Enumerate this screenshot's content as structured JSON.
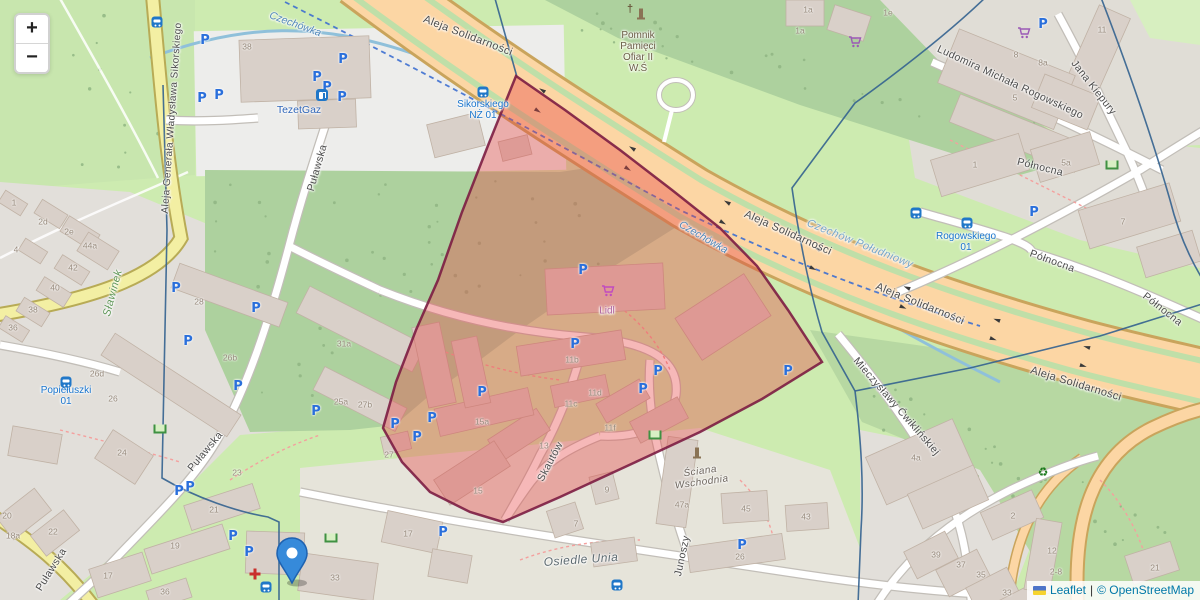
{
  "controls": {
    "zoom_in_label": "+",
    "zoom_out_label": "−"
  },
  "attribution": {
    "leaflet_link": "Leaflet",
    "separator": "|",
    "osm_text": "© OpenStreetMap"
  },
  "colors": {
    "overlay_fill": "#e84545",
    "overlay_stroke": "#7c1d42",
    "boundary": "#33628f",
    "marker_fill": "#368ada",
    "marker_stroke": "#1e62b0",
    "link": "#0078a8"
  },
  "overlay_polygon": {
    "points": "516,76 565,110 620,150 672,190 720,228 757,266 788,310 822,362 762,399 700,432 640,460 560,497 503,522 470,512 430,492 402,462 383,428 396,382 416,330 438,280 462,212 489,143",
    "fill_opacity": 0.38
  },
  "boundaries": [
    "M494,-5 L517,77",
    "M988,-5 C950,32 898,72 855,103 L792,188 C801,252 813,302 822,332 L855,391",
    "M855,391 L970,368 L1100,336 L1215,300",
    "M855,391 C861,440 864,485 861,530 L858,605",
    "M163,85 L167,230 L162,478 C196,498 238,512 268,517 L279,522 L279,605",
    "M1100,-5 C1125,60 1150,130 1170,200 C1180,240 1196,272 1215,298"
  ],
  "marker": {
    "x": 292,
    "y": 583
  },
  "map": {
    "street_labels": [
      {
        "text": "Aleja Solidarności",
        "x": 468,
        "y": 36,
        "rot": 21,
        "size": 11
      },
      {
        "text": "Aleja Solidarności",
        "x": 788,
        "y": 233,
        "rot": 24,
        "size": 11
      },
      {
        "text": "Aleja Solidarności",
        "x": 920,
        "y": 304,
        "rot": 22,
        "size": 11
      },
      {
        "text": "Aleja Solidarności",
        "x": 1076,
        "y": 384,
        "rot": 17,
        "size": 11
      },
      {
        "text": "Aleja Generała Władysława Sikorskiego",
        "x": 172,
        "y": 118,
        "rot": -86,
        "size": 10
      },
      {
        "text": "Puławska",
        "x": 318,
        "y": 168,
        "rot": -74
      },
      {
        "text": "Puławska",
        "x": 206,
        "y": 452,
        "rot": -50
      },
      {
        "text": "Puławska",
        "x": 52,
        "y": 570,
        "rot": -58
      },
      {
        "text": "Północna",
        "x": 1040,
        "y": 168,
        "rot": 14
      },
      {
        "text": "Północna",
        "x": 1052,
        "y": 262,
        "rot": 20
      },
      {
        "text": "Północna",
        "x": 1162,
        "y": 310,
        "rot": 38
      },
      {
        "text": "Ludomira Michała Rogowskiego",
        "x": 1010,
        "y": 83,
        "rot": 25
      },
      {
        "text": "Jana Kiepury",
        "x": 1093,
        "y": 88,
        "rot": 52
      },
      {
        "text": "Mieczysławy Ćwiklińskiej",
        "x": 896,
        "y": 407,
        "rot": 49
      },
      {
        "text": "Skautów",
        "x": 551,
        "y": 462,
        "rot": -62
      },
      {
        "text": "Junoszy",
        "x": 683,
        "y": 556,
        "rot": -78
      }
    ],
    "place_labels": [
      {
        "text": "Czechów Południowy",
        "x": 860,
        "y": 244,
        "rot": 22,
        "size": 11,
        "color": "#76a5c9"
      },
      {
        "text": "Sławinek",
        "x": 113,
        "y": 293,
        "rot": -75,
        "size": 11,
        "color": "#5f9657"
      },
      {
        "text": "Osiedle Unia",
        "x": 581,
        "y": 560,
        "rot": -4,
        "size": 12,
        "color": "#5d6a70"
      },
      {
        "lines": [
          "Ściana",
          "Wschodnia"
        ],
        "x": 701,
        "y": 477,
        "rot": -8,
        "size": 10,
        "color": "#6a625a"
      }
    ],
    "water_labels": [
      {
        "text": "Czechówka",
        "x": 295,
        "y": 25,
        "rot": 20
      },
      {
        "text": "Czechówka",
        "x": 703,
        "y": 238,
        "rot": 30
      }
    ],
    "bus_stop_labels": [
      {
        "lines": [
          "Sikorskiego",
          "NŻ 01"
        ],
        "x": 483,
        "y": 110
      },
      {
        "lines": [
          "Rogowskiego",
          "01"
        ],
        "x": 966,
        "y": 242
      },
      {
        "lines": [
          "Popiełuszki",
          "01"
        ],
        "x": 66,
        "y": 396
      }
    ],
    "poi_labels": [
      {
        "text": "TezetGaz",
        "x": 299,
        "y": 111,
        "color": "#3066b8",
        "size": 10.5
      },
      {
        "text": "Lidl",
        "x": 607,
        "y": 311,
        "color": "#b0639f"
      },
      {
        "lines": [
          "Pomnik",
          "Pamięci",
          "Ofiar II",
          "W.Ś"
        ],
        "x": 638,
        "y": 52,
        "color": "#6a5d45"
      }
    ],
    "house_numbers": [
      [
        247,
        47,
        "38"
      ],
      [
        43,
        222,
        "2d"
      ],
      [
        69,
        232,
        "2e"
      ],
      [
        90,
        246,
        "44a"
      ],
      [
        16,
        250,
        "4"
      ],
      [
        73,
        268,
        "42"
      ],
      [
        55,
        288,
        "40"
      ],
      [
        33,
        310,
        "38"
      ],
      [
        13,
        328,
        "36"
      ],
      [
        14,
        203,
        "1"
      ],
      [
        199,
        302,
        "28"
      ],
      [
        230,
        358,
        "26b"
      ],
      [
        344,
        344,
        "31a"
      ],
      [
        341,
        402,
        "25a"
      ],
      [
        365,
        405,
        "27b"
      ],
      [
        97,
        374,
        "26d"
      ],
      [
        113,
        399,
        "26"
      ],
      [
        122,
        453,
        "24"
      ],
      [
        237,
        473,
        "23"
      ],
      [
        7,
        516,
        "20"
      ],
      [
        13,
        536,
        "18a"
      ],
      [
        53,
        532,
        "22"
      ],
      [
        214,
        510,
        "21"
      ],
      [
        175,
        546,
        "19"
      ],
      [
        108,
        576,
        "17"
      ],
      [
        165,
        592,
        "36"
      ],
      [
        335,
        578,
        "33"
      ],
      [
        408,
        534,
        "17"
      ],
      [
        572,
        360,
        "11b"
      ],
      [
        482,
        422,
        "15a"
      ],
      [
        595,
        393,
        "11d"
      ],
      [
        571,
        404,
        "11c"
      ],
      [
        610,
        428,
        "11f"
      ],
      [
        544,
        446,
        "13"
      ],
      [
        389,
        455,
        "27"
      ],
      [
        478,
        491,
        "15"
      ],
      [
        607,
        490,
        "9"
      ],
      [
        576,
        524,
        "7"
      ],
      [
        682,
        505,
        "47a"
      ],
      [
        746,
        509,
        "45"
      ],
      [
        806,
        517,
        "43"
      ],
      [
        740,
        557,
        "26"
      ],
      [
        916,
        458,
        "4a"
      ],
      [
        936,
        555,
        "39"
      ],
      [
        961,
        565,
        "37"
      ],
      [
        981,
        575,
        "35"
      ],
      [
        1007,
        593,
        "33"
      ],
      [
        1013,
        516,
        "2"
      ],
      [
        1052,
        551,
        "12"
      ],
      [
        1056,
        572,
        "2-8"
      ],
      [
        1155,
        568,
        "21"
      ],
      [
        1066,
        163,
        "5a"
      ],
      [
        975,
        165,
        "1"
      ],
      [
        1123,
        222,
        "7"
      ],
      [
        1016,
        55,
        "8"
      ],
      [
        1043,
        63,
        "8a"
      ],
      [
        1015,
        98,
        "5"
      ],
      [
        1102,
        30,
        "11"
      ],
      [
        808,
        10,
        "1a"
      ],
      [
        800,
        31,
        "1a"
      ],
      [
        888,
        13,
        "1e"
      ]
    ],
    "parking_icons": [
      [
        205,
        41
      ],
      [
        202,
        99
      ],
      [
        219,
        96
      ],
      [
        317,
        78
      ],
      [
        327,
        88
      ],
      [
        343,
        60
      ],
      [
        342,
        98
      ],
      [
        583,
        271
      ],
      [
        575,
        345
      ],
      [
        643,
        390
      ],
      [
        658,
        372
      ],
      [
        788,
        372
      ],
      [
        482,
        393
      ],
      [
        432,
        419
      ],
      [
        395,
        425
      ],
      [
        417,
        438
      ],
      [
        256,
        309
      ],
      [
        188,
        342
      ],
      [
        176,
        289
      ],
      [
        238,
        387
      ],
      [
        316,
        412
      ],
      [
        1034,
        213
      ],
      [
        1043,
        25
      ],
      [
        179,
        492
      ],
      [
        190,
        488
      ],
      [
        233,
        537
      ],
      [
        249,
        553
      ],
      [
        443,
        533
      ],
      [
        742,
        546
      ]
    ],
    "bus_icons": [
      [
        483,
        92
      ],
      [
        916,
        213
      ],
      [
        967,
        223
      ],
      [
        66,
        382
      ],
      [
        266,
        587
      ],
      [
        617,
        585
      ],
      [
        157,
        22
      ]
    ],
    "shop_cart_icons": [
      {
        "x": 608,
        "y": 293,
        "color": "#c04ac0"
      },
      {
        "x": 1024,
        "y": 35,
        "color": "#9b59b6"
      },
      {
        "x": 855,
        "y": 44,
        "color": "#9b59b6"
      }
    ],
    "misc_icons": [
      {
        "type": "fuel",
        "x": 322,
        "y": 95
      },
      {
        "type": "pharmacy",
        "x": 255,
        "y": 574
      },
      {
        "type": "recycling",
        "x": 1043,
        "y": 472
      },
      {
        "type": "memorial-cross",
        "x": 630,
        "y": 9
      },
      {
        "type": "monument",
        "x": 641,
        "y": 13
      },
      {
        "type": "monument",
        "x": 697,
        "y": 452
      },
      {
        "type": "playground",
        "x": 1112,
        "y": 165
      },
      {
        "type": "playground",
        "x": 160,
        "y": 429
      },
      {
        "type": "playground",
        "x": 655,
        "y": 435
      },
      {
        "type": "playground",
        "x": 331,
        "y": 538
      }
    ]
  }
}
